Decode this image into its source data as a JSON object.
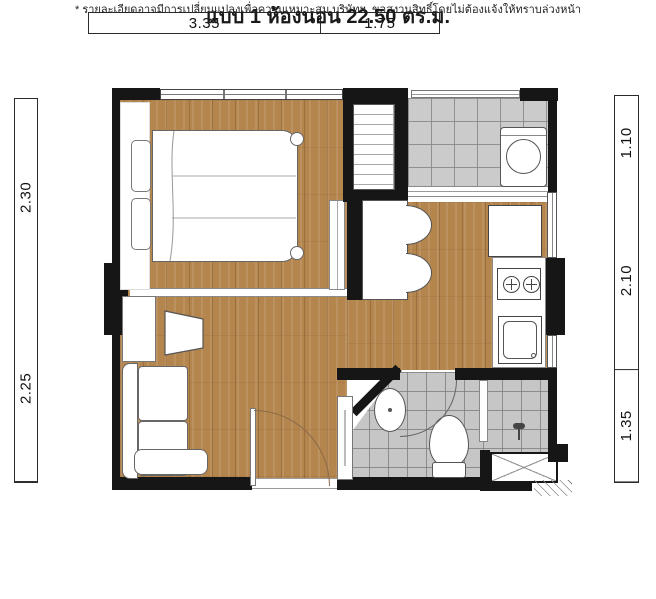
{
  "title": "แบบ 1 ห้องนอน 22.50 ตร.ม.",
  "unit": {
    "type_label": "แบบ 1 ห้องนอน",
    "area_value": "22.50",
    "area_unit": "ตร.ม."
  },
  "footnote": "* รายละเอียดอาจมีการเปลี่ยนแปลงเพื่อความเหมาะสม บริษัทฯ. ขอสงวนสิทธิ์โดยไม่ต้องแจ้งให้ทราบล่วงหน้า",
  "dimensions": {
    "top": [
      "3.35",
      "1.75"
    ],
    "left": [
      "2.30",
      "2.25"
    ],
    "right": [
      "1.10",
      "2.10",
      "1.35"
    ]
  },
  "colors": {
    "wood_floor": "#b5854e",
    "wall": "#161616",
    "tile": "#cbcbcb",
    "door_arc": "#8b6b48"
  },
  "fixtures": [
    "bed",
    "wardrobe",
    "balcony-railing",
    "washing-machine",
    "sliding-door",
    "dining-counter",
    "chair",
    "refrigerator",
    "stove",
    "kitchen-sink",
    "sofa",
    "tv",
    "tv-console",
    "shoe-cabinet",
    "bathroom-basin",
    "toilet",
    "shower",
    "entrance-door",
    "ac-ledge"
  ]
}
